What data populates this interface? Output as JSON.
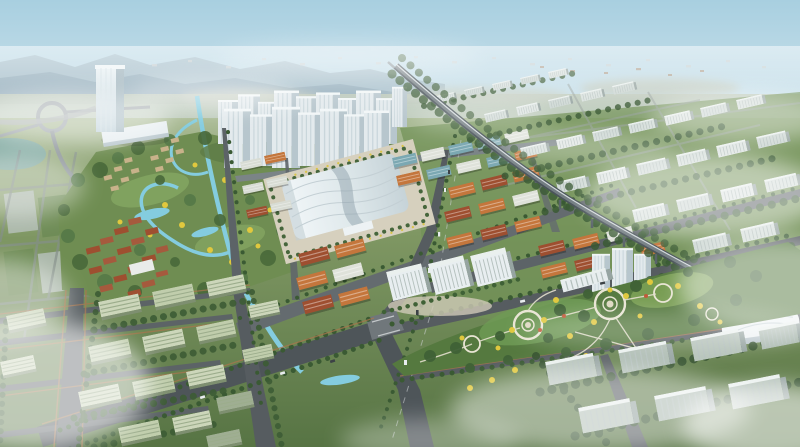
{
  "image": {
    "title": "Aerial bird's-eye rendering of a planned urban district",
    "type": "architectural-visualization",
    "visible_text": "none"
  },
  "palette": {
    "sky_top": "#a8cfe0",
    "sky_horizon": "#e4eef0",
    "mountains": "#93aebb",
    "far_plain": "#b4c2a8",
    "ground_green": "#6a8a52",
    "deep_green": "#3a5a33",
    "lawn": "#7fa558",
    "water": "#84ccdf",
    "road": "#565c60",
    "road_far": "#7b8487",
    "viaduct": "#4a545a",
    "building_white": "#e3eaed",
    "building_side": "#b7c6cd",
    "roof_red": "#9e4f30",
    "roof_orange": "#c4763c",
    "roof_teal": "#7ba8b2",
    "warehouse": "#ccd6ba",
    "plaza": "#d6d0be",
    "autumn_yellow": "#e0c83e",
    "hedge_orange": "#a8764e",
    "cloud": "#ffffff"
  },
  "scene": {
    "view": "high oblique aerial view",
    "weather": "hazy daylight with drifting mist",
    "regions": [
      {
        "name": "sky",
        "label": "Hazy sky over distant mountain ridges"
      },
      {
        "name": "landmark-tower",
        "label": "Glass office tower on the west side"
      },
      {
        "name": "eco-town",
        "label": "Low-rise red-roof town in waterside parkland"
      },
      {
        "name": "residential-towers",
        "label": "White high-rise apartment cluster"
      },
      {
        "name": "exhibition-hall",
        "label": "White wave-roofed exhibition hall"
      },
      {
        "name": "trade-blocks",
        "label": "Dense grid of low-rise trade buildings"
      },
      {
        "name": "elevated-railway",
        "label": "Elevated railway viaduct on piers"
      },
      {
        "name": "east-slab-district",
        "label": "Staggered rows of mid-rise slab housing"
      },
      {
        "name": "industrial-zone",
        "label": "Rows of gable-roofed warehouses among trees"
      },
      {
        "name": "central-park",
        "label": "Park with circular plazas and yellow autumn trees"
      },
      {
        "name": "southeast-district",
        "label": "Slab buildings fading into mist"
      },
      {
        "name": "road-network",
        "label": "Boulevard grid meeting at a central intersection"
      },
      {
        "name": "canal",
        "label": "Winding light-blue canal system"
      },
      {
        "name": "clouds",
        "label": "White mist drifting across the view"
      }
    ]
  }
}
